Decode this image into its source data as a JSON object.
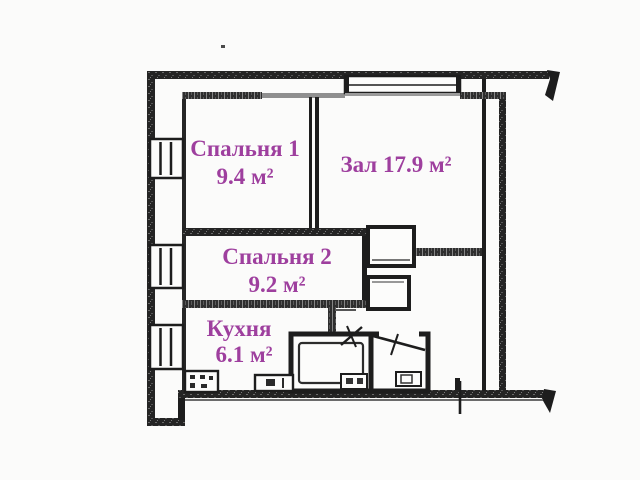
{
  "colors": {
    "label_text": "#9e3f9e",
    "wall": "#1d1d1d",
    "background": "#fbfbfa"
  },
  "rooms": [
    {
      "key": "bedroom-1",
      "name": "Спальня 1",
      "area": "9.4 м²"
    },
    {
      "key": "living-room",
      "name": "Зал 17.9 м²",
      "area": ""
    },
    {
      "key": "bedroom-2",
      "name": "Спальня 2",
      "area": "9.2 м²"
    },
    {
      "key": "kitchen",
      "name": "Кухня",
      "area": "6.1 м²"
    }
  ]
}
